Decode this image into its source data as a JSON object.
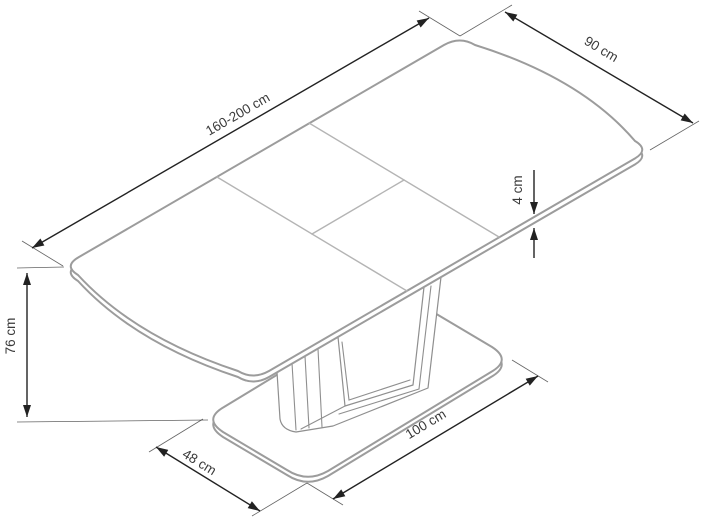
{
  "colors": {
    "table-line": "#9c9c9c",
    "seam": "#b4b4b4",
    "pedestal-line": "#8f8f8f",
    "dimension": "#222222",
    "text": "#3a3a3a",
    "background": "#ffffff"
  },
  "labels": {
    "length": "160-200 cm",
    "width": "90 cm",
    "thickness": "4 cm",
    "height": "76 cm",
    "base_width": "48 cm",
    "base_length": "100 cm"
  }
}
